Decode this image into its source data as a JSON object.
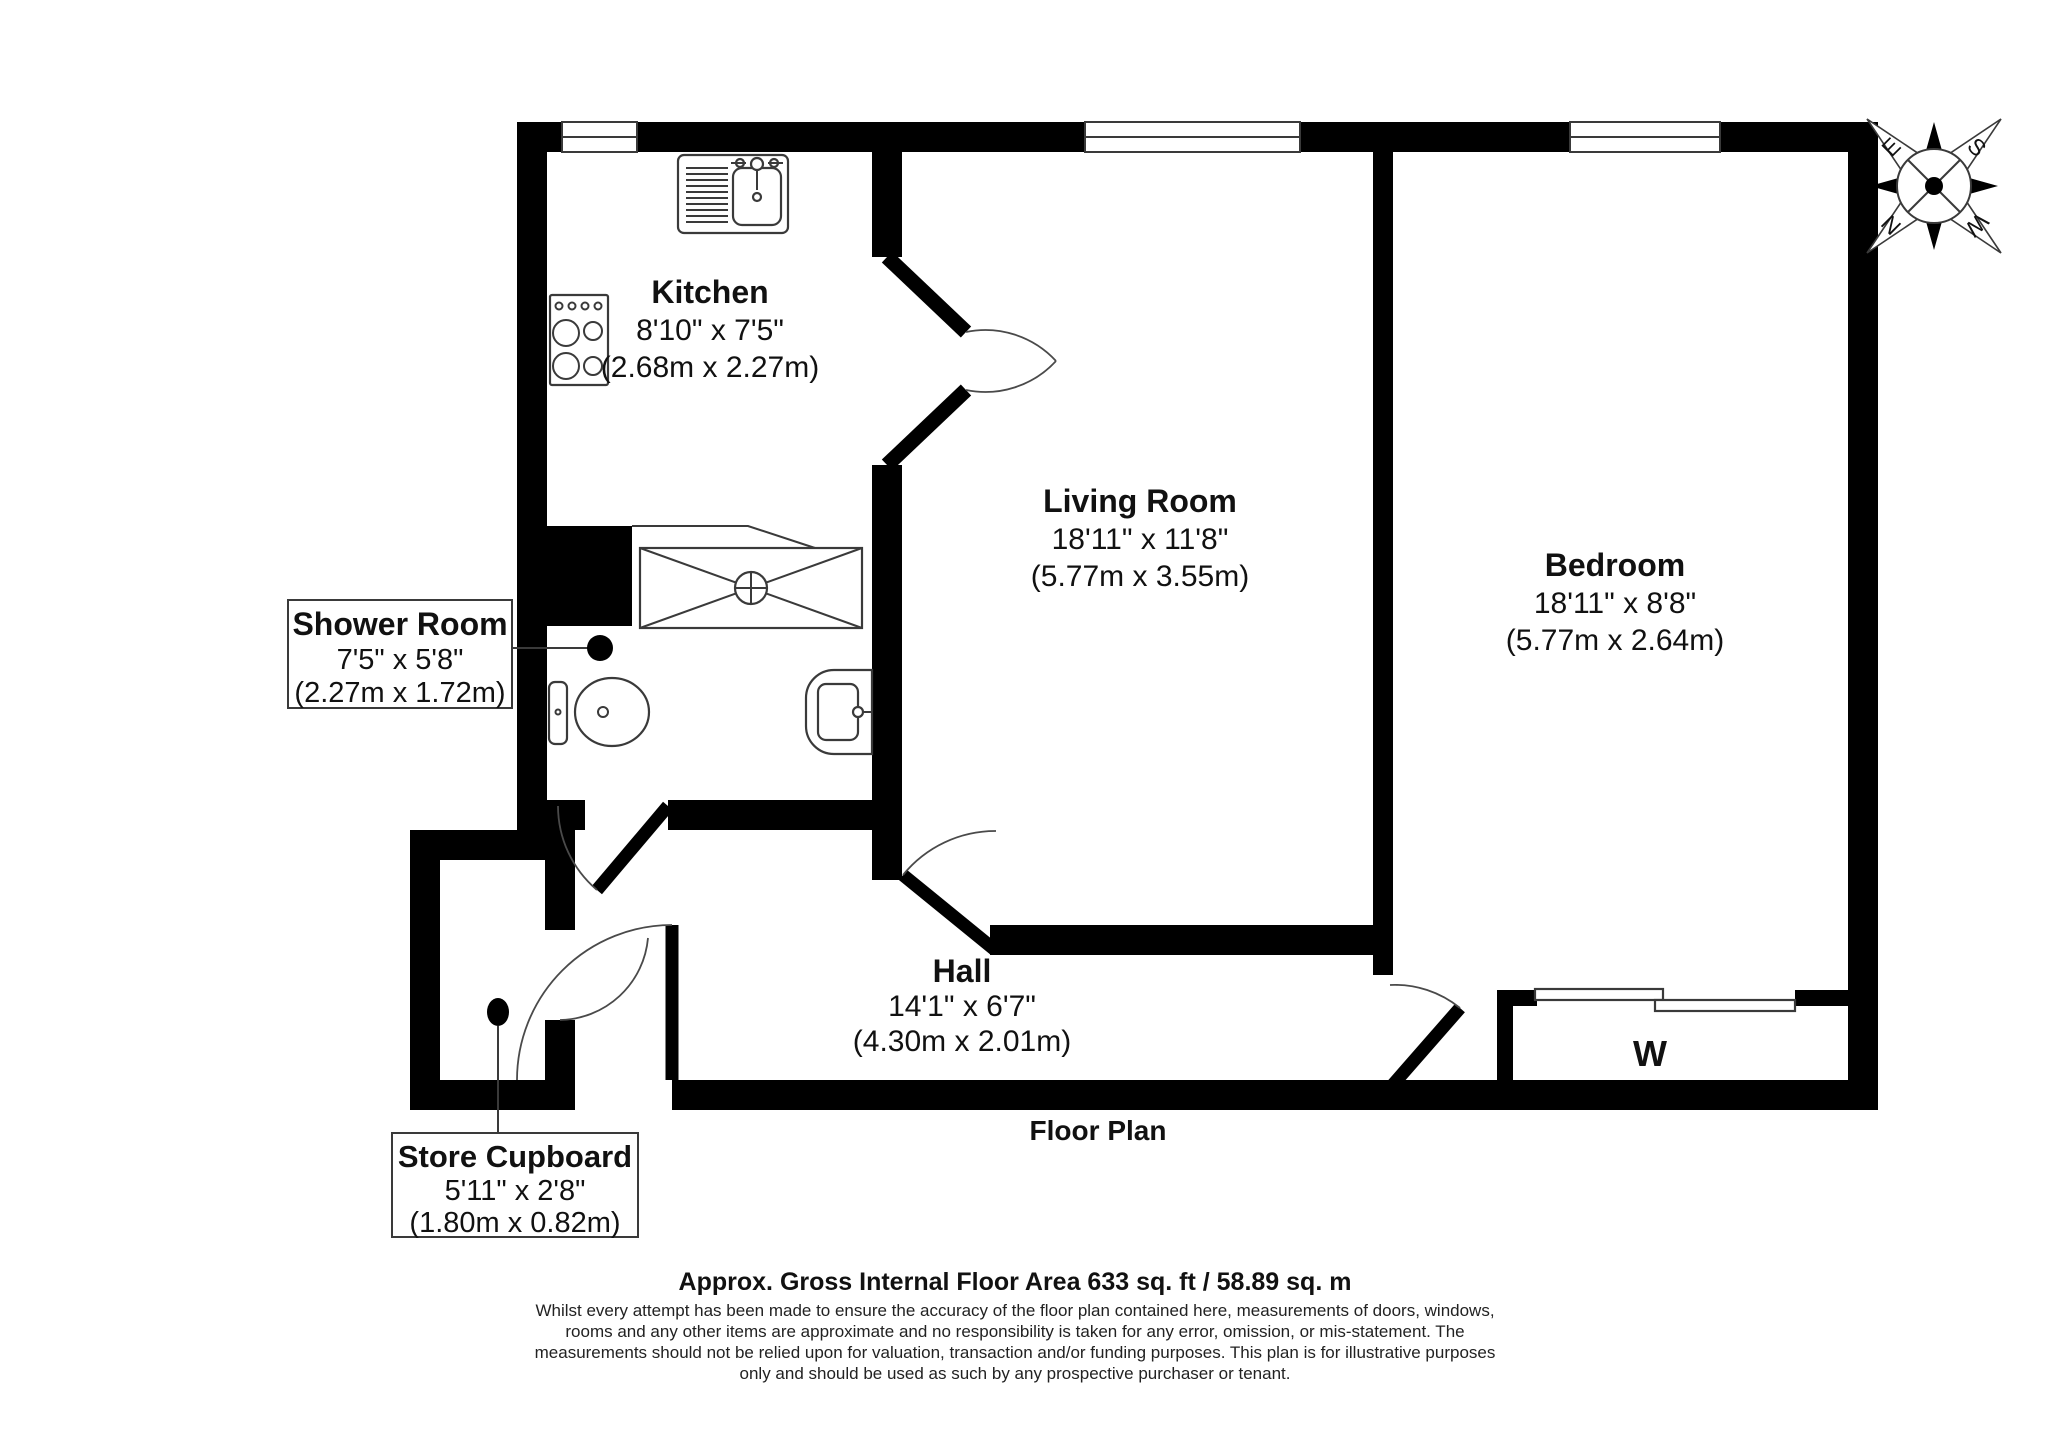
{
  "colors": {
    "wall": "#000000",
    "line": "#3a3a3a",
    "background": "#ffffff"
  },
  "plan_title": "Floor Plan",
  "wardrobe_label": "W",
  "rooms": [
    {
      "name": "Kitchen",
      "imperial": "8'10\" x 7'5\"",
      "metric": "(2.68m x 2.27m)"
    },
    {
      "name": "Living Room",
      "imperial": "18'11\" x 11'8\"",
      "metric": "(5.77m x 3.55m)"
    },
    {
      "name": "Bedroom",
      "imperial": "18'11\" x 8'8\"",
      "metric": "(5.77m x 2.64m)"
    },
    {
      "name": "Shower Room",
      "imperial": "7'5\" x 5'8\"",
      "metric": "(2.27m x 1.72m)"
    },
    {
      "name": "Hall",
      "imperial": "14'1\" x 6'7\"",
      "metric": "(4.30m x 2.01m)"
    },
    {
      "name": "Store Cupboard",
      "imperial": "5'11\" x 2'8\"",
      "metric": "(1.80m x 0.82m)"
    }
  ],
  "compass": {
    "north": "N",
    "east": "E",
    "south": "S",
    "west": "W"
  },
  "footer": {
    "area": "Approx. Gross Internal Floor Area 633 sq. ft / 58.89 sq. m",
    "disclaimer": [
      "Whilst every attempt has been made to ensure the accuracy of the floor plan contained here, measurements of doors, windows,",
      "rooms and any other items are approximate and no responsibility is taken for any error, omission, or mis-statement. The",
      "measurements should not be relied upon for valuation, transaction and/or funding purposes. This plan is for illustrative purposes",
      "only and should be used as such by any prospective purchaser or tenant."
    ]
  }
}
